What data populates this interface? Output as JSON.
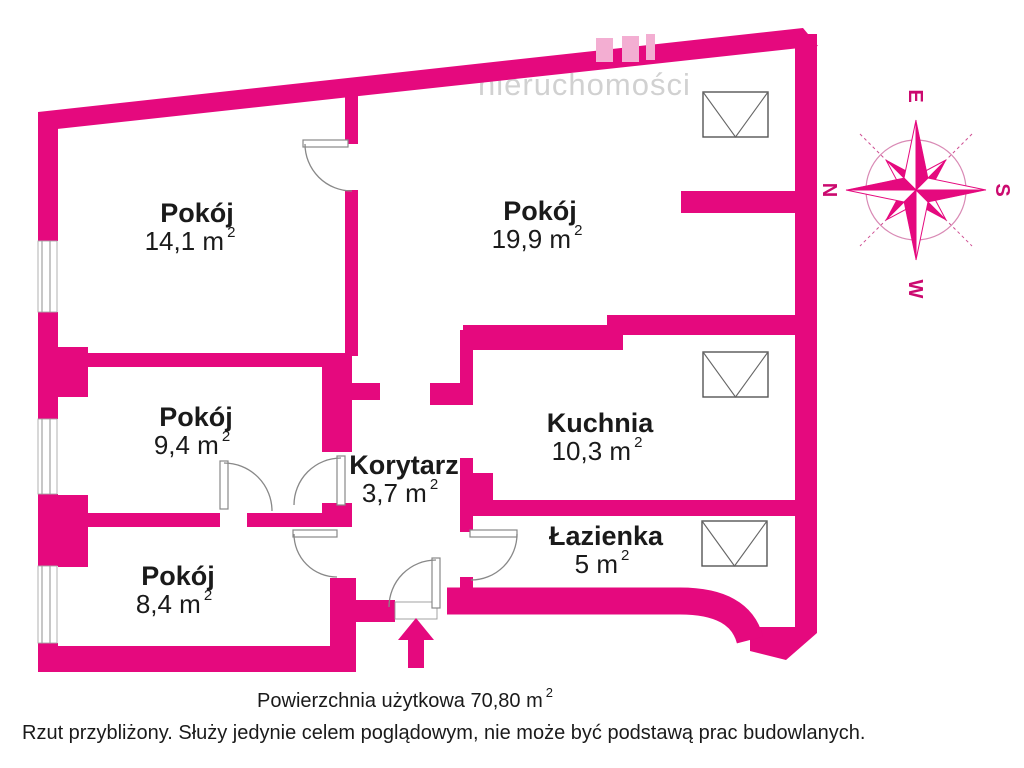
{
  "watermark": "nieruchomości",
  "rooms": [
    {
      "name": "Pokój",
      "area": "14,1 m",
      "sup": "2"
    },
    {
      "name": "Pokój",
      "area": "19,9 m",
      "sup": "2"
    },
    {
      "name": "Pokój",
      "area": "9,4 m",
      "sup": "2"
    },
    {
      "name": "Korytarz",
      "area": "3,7 m",
      "sup": "2"
    },
    {
      "name": "Kuchnia",
      "area": "10,3 m",
      "sup": "2"
    },
    {
      "name": "Łazienka",
      "area": "5 m",
      "sup": "2"
    },
    {
      "name": "Pokój",
      "area": "8,4 m",
      "sup": "2"
    }
  ],
  "compass": {
    "n": "N",
    "e": "E",
    "s": "S",
    "w": "W"
  },
  "footer": {
    "total": "Powierzchnia użytkowa 70,80 m",
    "total_sup": "2",
    "disclaimer": "Rzut przybliżony. Służy jedynie celem poglądowym, nie może być podstawą prac budowlanych."
  },
  "colors": {
    "wall": "#e5097e",
    "logo": "#f3aed2",
    "door": "#888888",
    "text": "#1a1a1a"
  }
}
